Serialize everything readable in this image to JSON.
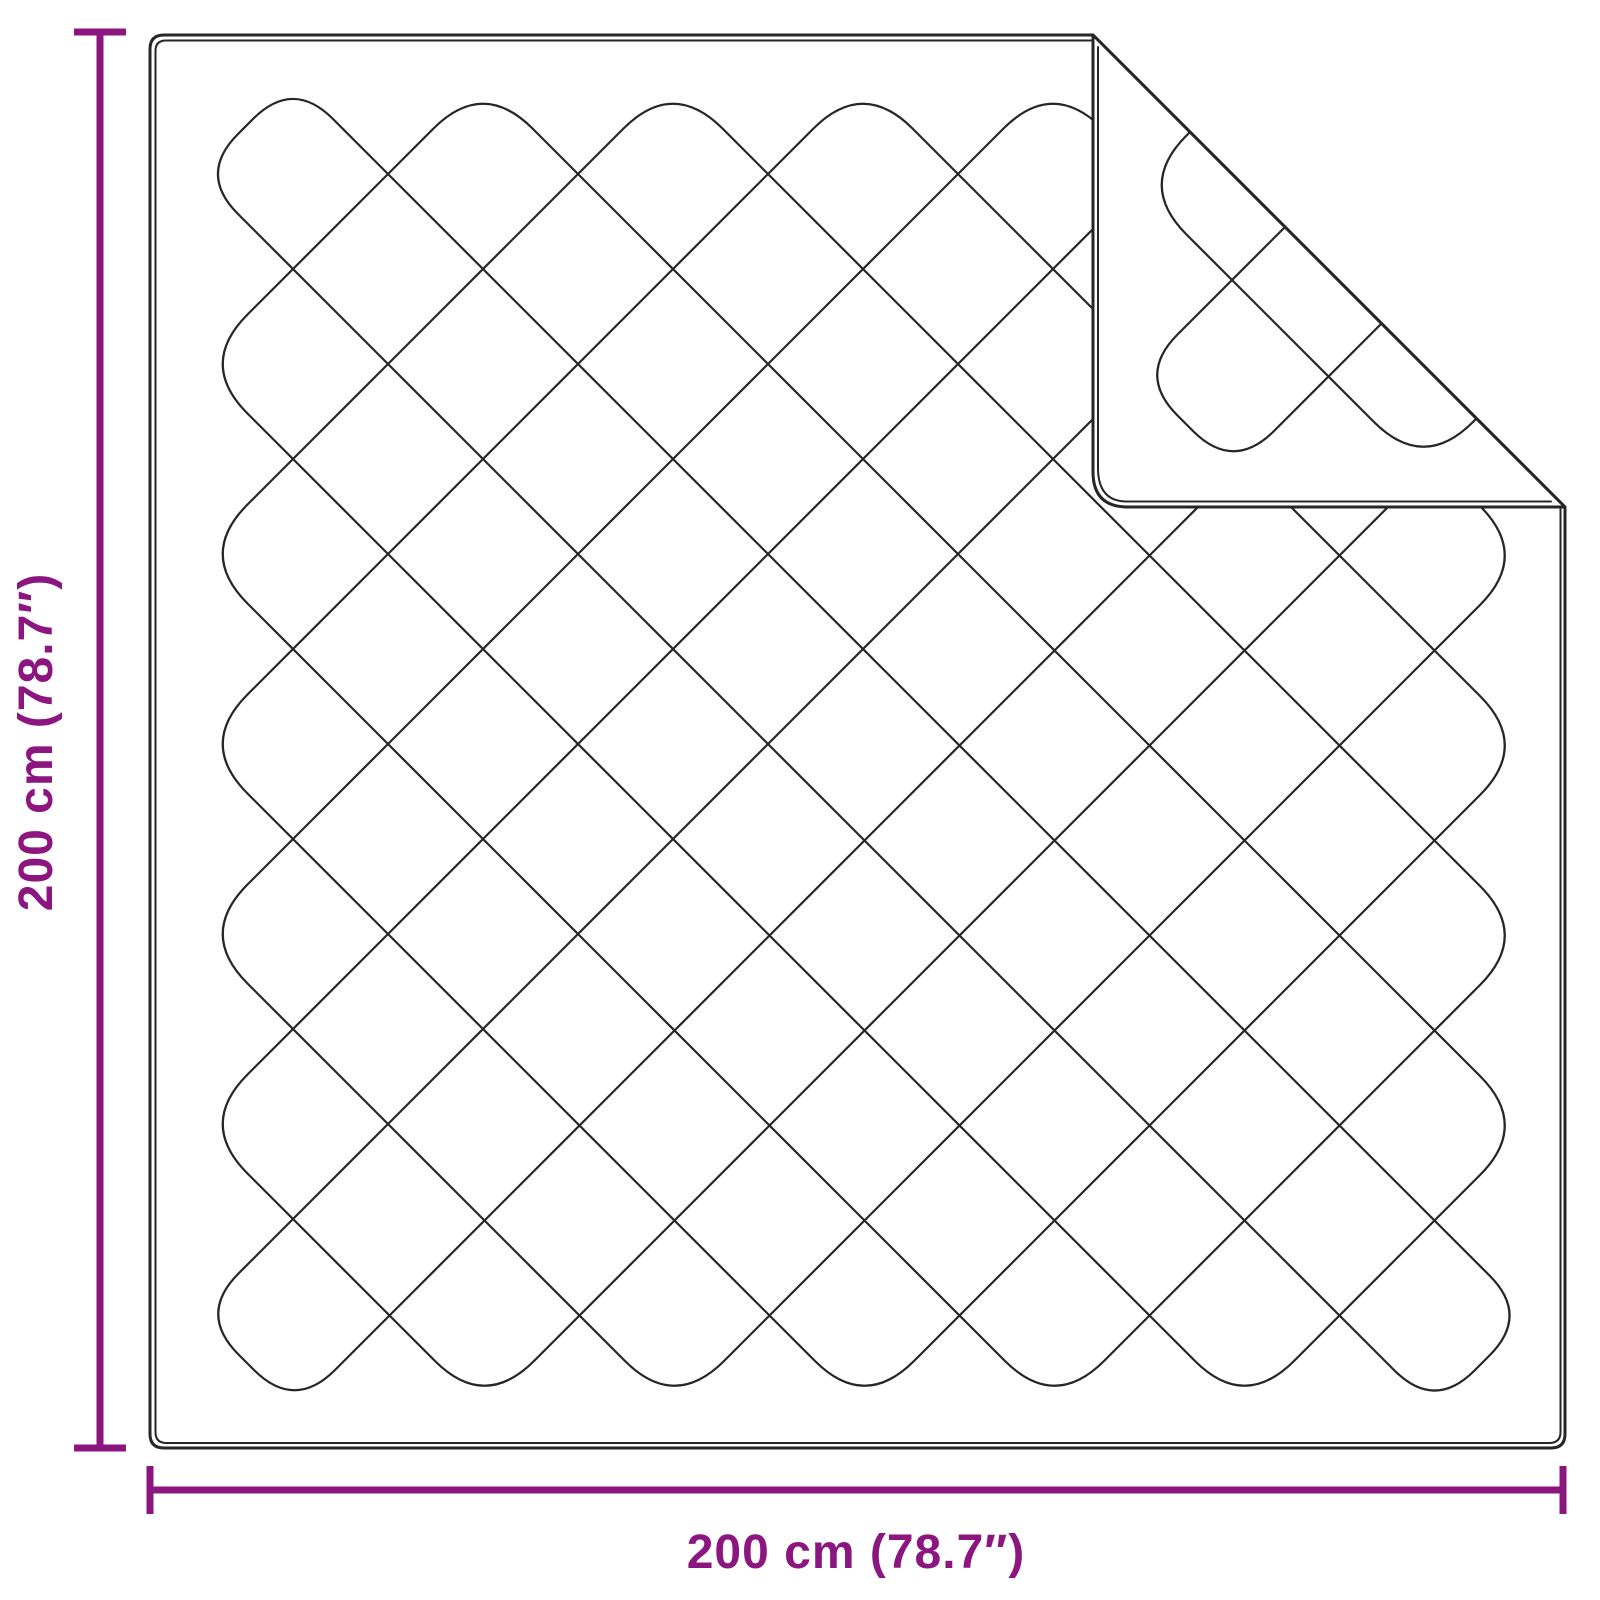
{
  "diagram": {
    "labels": {
      "height": "200 cm (78.7″)",
      "width": "200 cm (78.7″)"
    },
    "dimensions": {
      "width_cm": 200,
      "height_cm": 200,
      "width_in": 78.7,
      "height_in": 78.7
    },
    "colors": {
      "accent": "#8C1680",
      "outline": "#262626",
      "background": "#FFFFFF"
    }
  }
}
